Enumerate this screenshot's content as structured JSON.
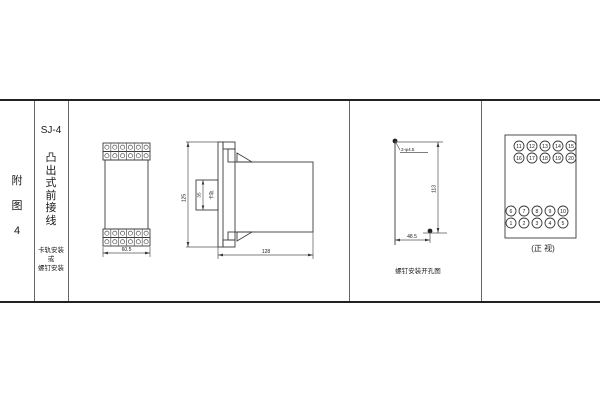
{
  "figure_label": {
    "chars": [
      "附",
      "图",
      "4"
    ]
  },
  "title_block": {
    "model": "SJ-4",
    "type_chars": [
      "凸",
      "出",
      "式",
      "前",
      "接",
      "线"
    ],
    "mount_line1": "卡轨安装",
    "mount_line2": "或",
    "mount_line3": "螺钉安装"
  },
  "front_outline_view": {
    "width_dim": "60.5"
  },
  "side_view": {
    "height_dim": "125",
    "slot_dim": "35",
    "slot_label": "卡轨",
    "depth_dim": "128"
  },
  "drill_view": {
    "holes_label": "2-φ4.5",
    "vertical_dim": "113",
    "horizontal_dim": "48.5",
    "caption": "螺钉安装开孔图"
  },
  "terminal_view": {
    "caption": "(正 视)",
    "top_rows": [
      [
        "11",
        "12",
        "13",
        "14",
        "15"
      ],
      [
        "16",
        "17",
        "18",
        "19",
        "20"
      ]
    ],
    "bottom_rows": [
      [
        "6",
        "7",
        "8",
        "9",
        "10"
      ],
      [
        "1",
        "2",
        "3",
        "4",
        "5"
      ]
    ]
  },
  "colors": {
    "line": "#3a3a3a",
    "border": "#222222",
    "text": "#1a1a1a"
  }
}
